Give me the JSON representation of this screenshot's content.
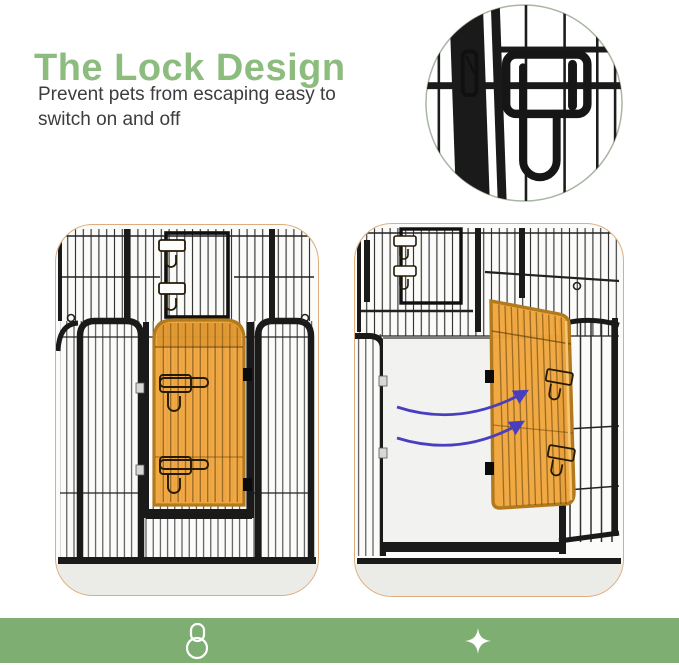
{
  "header": {
    "title": "The Lock Design",
    "subtitle_line1": "Prevent pets from escaping easy to",
    "subtitle_line2": "switch on and off"
  },
  "figures": {
    "lock_closeup": {
      "name": "lock-closeup-inset"
    },
    "door_closed": {
      "name": "door-closed-panel"
    },
    "door_open": {
      "name": "door-open-panel"
    }
  },
  "footer": {
    "icons": [
      {
        "name": "padlock-icon"
      },
      {
        "name": "sparkle-icon"
      }
    ]
  },
  "colors": {
    "title_green": "#8dbc7f",
    "text_gray": "#3d3d3d",
    "footer_green": "#7fae72",
    "panel_border": "#dcae7d",
    "panel_bg": "#fbfbf9",
    "floor_gray": "#ebebe8",
    "door_orange": "#f0a63d",
    "door_border": "#b27a1d",
    "arrow_purple": "#4a3ec0",
    "fence_black": "#1a1a1a",
    "inset_border": "#a9b6a3",
    "icon_white": "#ffffff"
  }
}
